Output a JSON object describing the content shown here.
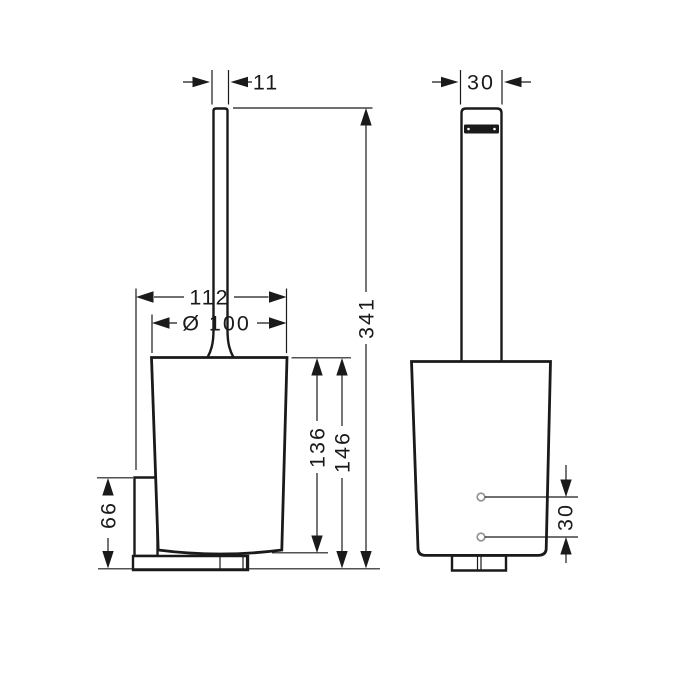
{
  "drawing": {
    "type": "technical-dimension-drawing",
    "subject": "wall-mounted toilet brush holder, side view and front view",
    "colors": {
      "line": "#1a1a1a",
      "background": "#ffffff",
      "screw_hole": "#8f8f8f",
      "grip_bar": "#1a1a1a"
    }
  },
  "dimensions": {
    "side_handle_width": "11",
    "front_handle_width": "30",
    "overall_width": "112",
    "cup_diameter": "Ø 100",
    "bracket_height": "66",
    "cup_height": "136",
    "body_height": "146",
    "total_height": "341",
    "screw_hole_spacing": "30"
  }
}
